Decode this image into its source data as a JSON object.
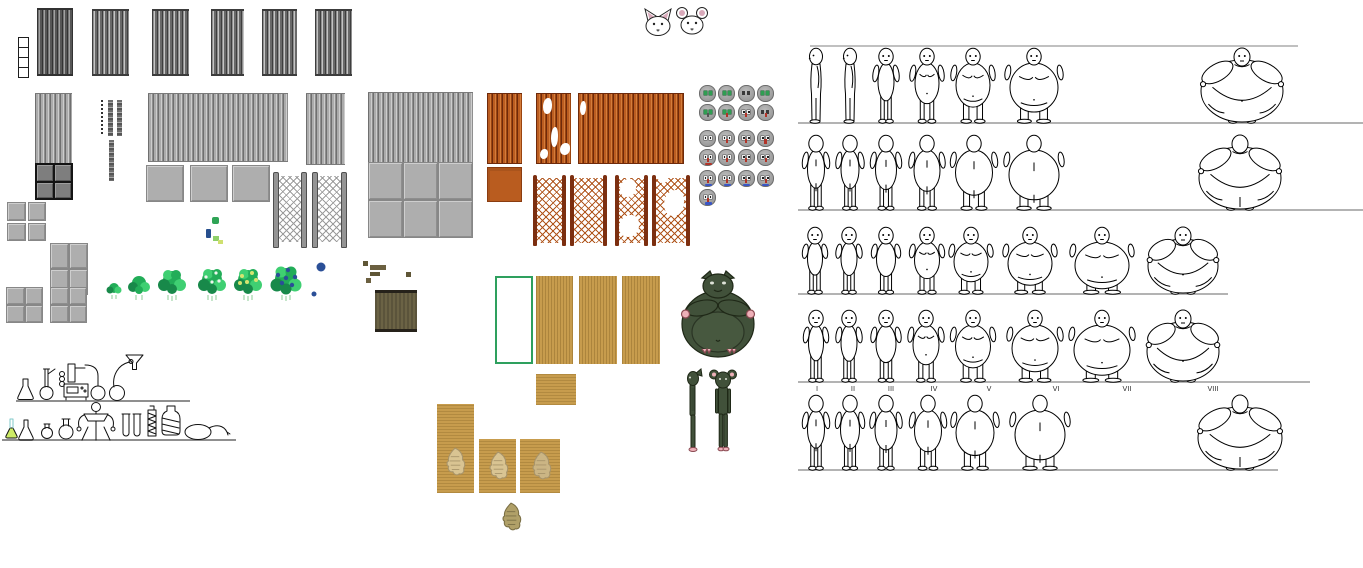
{
  "canvas": {
    "width": 1363,
    "height": 568,
    "background": "#ffffff"
  },
  "palette": {
    "metal_dark": "#696969",
    "metal_stripe": "#3e3e3e",
    "metal_light": "#ababab",
    "stone": "#aeaeae",
    "plate_dark": "#7e7e7e",
    "rust": "#bb5d20",
    "rust_dark": "#6e2a0b",
    "rust_post": "#7c2f10",
    "wood_tan": "#c79c4d",
    "outline_green": "#2ea05e",
    "bush_green": "#22ad58",
    "bush_dark": "#18894a",
    "bush_light": "#3fcf72",
    "berry_blue": "#2b4f97",
    "flower_yellow": "#d6e470",
    "goblin_green": "#41513a",
    "goblin_outline": "#1f2817",
    "goblin_pink": "#eeb0b8",
    "face_gray": "#9c9c9c",
    "face_eye_green": "#2f9e52",
    "face_nose_red": "#b23327",
    "face_mouth_blue": "#3a56c4",
    "mouse_white": "#ffffff",
    "mouse_ear_pink": "#d9a9ba",
    "line_gray": "#999999",
    "figure_ink": "#000000",
    "olive_panel": "#6b6345",
    "leaf_tan": "#d9c492",
    "leaf_olive": "#b0a068"
  },
  "sprites": [
    "corrugated-metal-panel",
    "film-strip",
    "zigzag-strip",
    "stone-tile-block",
    "metal-plate-grid",
    "chainlink-fence-gray",
    "chainlink-fence-rust",
    "rust-corrugated-panel",
    "rust-tile",
    "emote-face-grid",
    "mouse-head",
    "bush-row",
    "berry-dot",
    "lab-glassware-shelf",
    "wood-panel",
    "wood-panel-outline",
    "leaf-decal",
    "goblin-large",
    "goblin-small",
    "body-type-reference-chart"
  ],
  "faces": {
    "x": 699,
    "col_w": 19.3,
    "legend": {
      "e": "eyes: g=green d=dark w=white",
      "n": "nose: r=red d=dark R=big-red",
      "m": "mouth: b=blue B=big-blue r=red"
    },
    "rows": [
      {
        "y": 85,
        "faces": [
          {
            "e": "g"
          },
          {
            "e": "g"
          },
          {
            "e": "d"
          },
          {
            "e": "g"
          }
        ]
      },
      {
        "y": 104,
        "faces": [
          {
            "e": "g",
            "n": "d"
          },
          {
            "e": "g",
            "n": "r"
          },
          {
            "e": "w",
            "n": "r"
          },
          {
            "e": "d",
            "n": "r"
          }
        ]
      },
      {
        "y": 130,
        "faces": [
          {
            "e": "w"
          },
          {
            "e": "w",
            "n": "r"
          },
          {
            "e": "w",
            "n": "r"
          },
          {
            "e": "w",
            "n": "R"
          }
        ]
      },
      {
        "y": 149,
        "faces": [
          {
            "e": "w",
            "n": "r",
            "m": "r"
          },
          {
            "e": "w",
            "n": "r"
          },
          {
            "e": "w",
            "n": "r"
          },
          {
            "e": "w",
            "n": "r"
          }
        ]
      },
      {
        "y": 170,
        "faces": [
          {
            "e": "w",
            "n": "r",
            "m": "b"
          },
          {
            "e": "w",
            "n": "r",
            "m": "b"
          },
          {
            "e": "w",
            "n": "r",
            "m": "b"
          },
          {
            "e": "w",
            "n": "r",
            "m": "b"
          }
        ]
      },
      {
        "y": 189,
        "faces": [
          {
            "e": "w",
            "n": "r",
            "m": "B"
          }
        ]
      }
    ]
  },
  "figure_chart": {
    "description": "body-type progression reference rows, thin to obese",
    "top_line": {
      "x1": 810,
      "y": 46,
      "x2": 1298
    },
    "labels": [
      "I",
      "II",
      "III",
      "IV",
      "V",
      "VI",
      "VII",
      "VIII"
    ],
    "label_x": [
      817,
      853,
      891,
      934,
      989,
      1056,
      1127,
      1213
    ],
    "rows": [
      {
        "name": "front-row-1",
        "baseline": 123,
        "h": 75,
        "line_x1": 798,
        "line_x2": 1363,
        "labeled": false,
        "figures": [
          {
            "cx": 816,
            "w": 14,
            "view": "side"
          },
          {
            "cx": 850,
            "w": 14,
            "view": "side"
          },
          {
            "cx": 886,
            "w": 16,
            "view": "front"
          },
          {
            "cx": 927,
            "w": 24,
            "view": "front"
          },
          {
            "cx": 973,
            "w": 34,
            "view": "front"
          },
          {
            "cx": 1034,
            "w": 48,
            "view": "front"
          },
          {
            "cx": 1242,
            "w": 82,
            "view": "huge-front"
          }
        ]
      },
      {
        "name": "back-row-1",
        "baseline": 210,
        "h": 75,
        "line_x1": 798,
        "line_x2": 1363,
        "labeled": false,
        "figures": [
          {
            "cx": 816,
            "w": 17,
            "view": "back"
          },
          {
            "cx": 850,
            "w": 18,
            "view": "back"
          },
          {
            "cx": 886,
            "w": 21,
            "view": "back"
          },
          {
            "cx": 927,
            "w": 26,
            "view": "back"
          },
          {
            "cx": 974,
            "w": 37,
            "view": "back"
          },
          {
            "cx": 1034,
            "w": 50,
            "view": "back"
          },
          {
            "cx": 1240,
            "w": 82,
            "view": "huge-back"
          }
        ]
      },
      {
        "name": "front-row-2",
        "baseline": 294,
        "h": 67,
        "line_x1": 798,
        "line_x2": 1228,
        "labeled": false,
        "figures": [
          {
            "cx": 815,
            "w": 15,
            "view": "front"
          },
          {
            "cx": 849,
            "w": 16,
            "view": "front"
          },
          {
            "cx": 886,
            "w": 19,
            "view": "front"
          },
          {
            "cx": 927,
            "w": 25,
            "view": "front"
          },
          {
            "cx": 971,
            "w": 34,
            "view": "front"
          },
          {
            "cx": 1030,
            "w": 44,
            "view": "front"
          },
          {
            "cx": 1102,
            "w": 54,
            "view": "front"
          },
          {
            "cx": 1183,
            "w": 70,
            "view": "huge-front"
          }
        ]
      },
      {
        "name": "front-row-labeled",
        "baseline": 382,
        "h": 72,
        "line_x1": 798,
        "line_x2": 1310,
        "labeled": true,
        "figures": [
          {
            "cx": 816,
            "w": 15,
            "view": "front"
          },
          {
            "cx": 849,
            "w": 16,
            "view": "front"
          },
          {
            "cx": 886,
            "w": 20,
            "view": "front"
          },
          {
            "cx": 926,
            "w": 26,
            "view": "front"
          },
          {
            "cx": 973,
            "w": 35,
            "view": "front"
          },
          {
            "cx": 1035,
            "w": 46,
            "view": "front"
          },
          {
            "cx": 1102,
            "w": 56,
            "view": "front"
          },
          {
            "cx": 1183,
            "w": 72,
            "view": "huge-front"
          }
        ]
      },
      {
        "name": "back-row-2",
        "baseline": 470,
        "h": 75,
        "line_x1": 798,
        "line_x2": 1278,
        "labeled": false,
        "figures": [
          {
            "cx": 816,
            "w": 17,
            "view": "back"
          },
          {
            "cx": 850,
            "w": 19,
            "view": "back"
          },
          {
            "cx": 886,
            "w": 22,
            "view": "back"
          },
          {
            "cx": 928,
            "w": 27,
            "view": "back"
          },
          {
            "cx": 975,
            "w": 38,
            "view": "back"
          },
          {
            "cx": 1040,
            "w": 50,
            "view": "back"
          },
          {
            "cx": 1240,
            "w": 84,
            "view": "huge-back"
          }
        ]
      }
    ]
  }
}
